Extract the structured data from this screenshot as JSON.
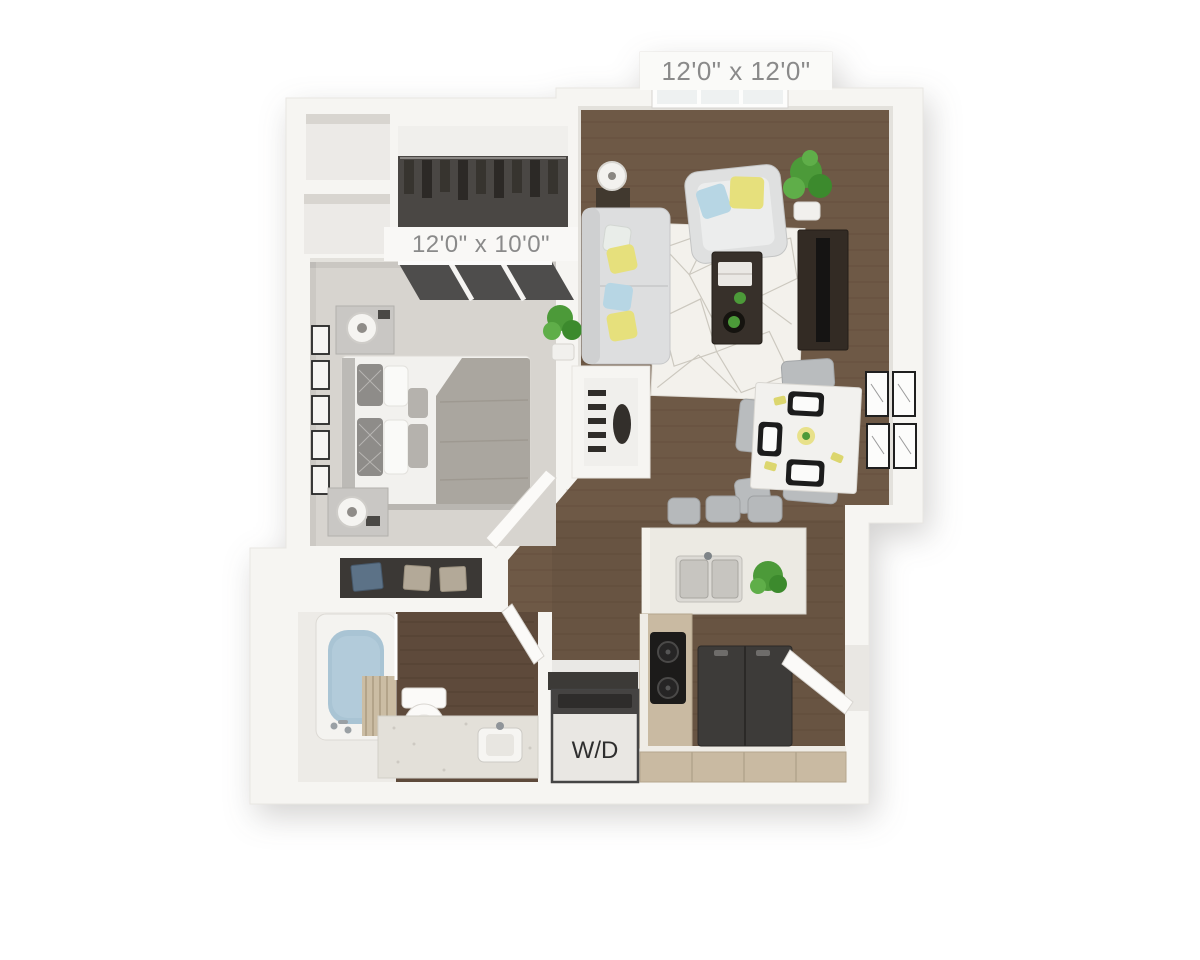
{
  "plan": {
    "scene": "one-bedroom-apartment-3d-floor-plan",
    "labels": {
      "living_room_dimensions": "12'0\" x 12'0\"",
      "bedroom_dimensions": "12'0\" x 10'0\"",
      "washer_dryer": "W/D"
    },
    "rooms": [
      {
        "name": "living-room",
        "dimensions": "12'0\" x 12'0\""
      },
      {
        "name": "bedroom",
        "dimensions": "12'0\" x 10'0\""
      },
      {
        "name": "dining-area"
      },
      {
        "name": "kitchen"
      },
      {
        "name": "bathroom"
      },
      {
        "name": "walk-in-closet"
      },
      {
        "name": "hall-closets"
      },
      {
        "name": "storage-niche"
      },
      {
        "name": "laundry-closet",
        "label": "W/D"
      },
      {
        "name": "entry"
      },
      {
        "name": "hallway"
      }
    ],
    "colors": {
      "background": "#ffffff",
      "wall": "#f6f5f2",
      "wall_shadow": "#e3e1dc",
      "wood_floor": "#6e5946",
      "bathroom_floor": "#5e4a3b",
      "carpet": "#d7d4cf",
      "rug": "#f3f1ec",
      "counter": "#eceae3",
      "cabinet_wood": "#c9baa2",
      "sofa_gray": "#dddedf",
      "pillow_yellow": "#e6e07c",
      "pillow_blue": "#b7d6e4",
      "plant_green": "#4c9a39",
      "dark_wood_furniture": "#37302a",
      "appliance_dark": "#3d3b39",
      "tub_water": "#a9c4d4",
      "label_text": "#8a8a8a",
      "wd_text": "#2e2e2e",
      "frame_black": "#1f1f1f"
    }
  }
}
